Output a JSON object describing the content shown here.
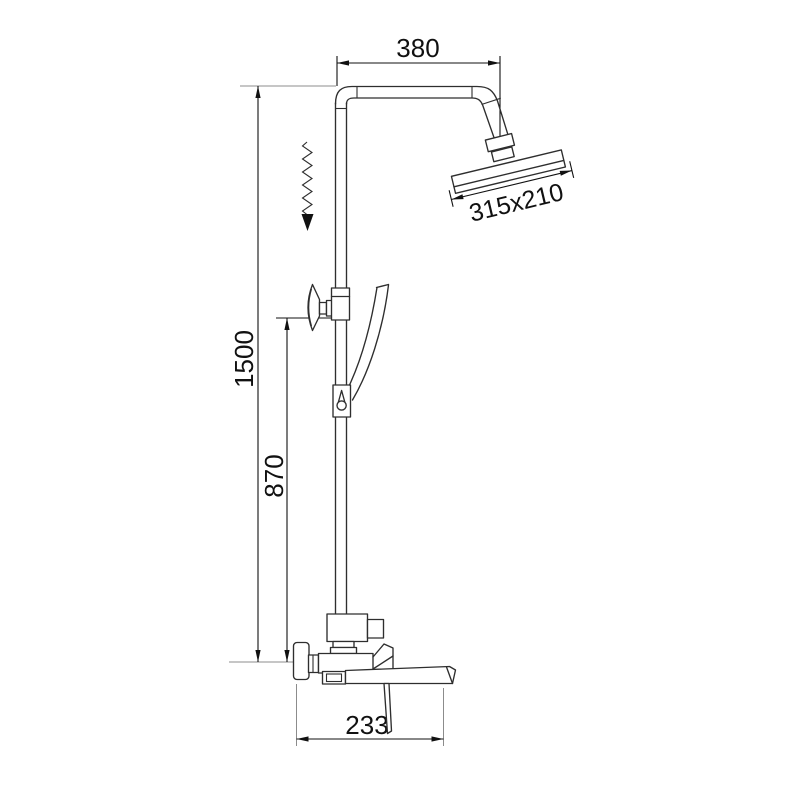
{
  "drawing": {
    "dimensions": {
      "top_offset": "380",
      "head_size": "315x210",
      "total_height": "1500",
      "riser_height": "870",
      "spout_reach": "233"
    },
    "colors": {
      "background": "#ffffff",
      "line": "#2e2e2e",
      "extension": "#8c8c8c",
      "text": "#111111"
    }
  }
}
